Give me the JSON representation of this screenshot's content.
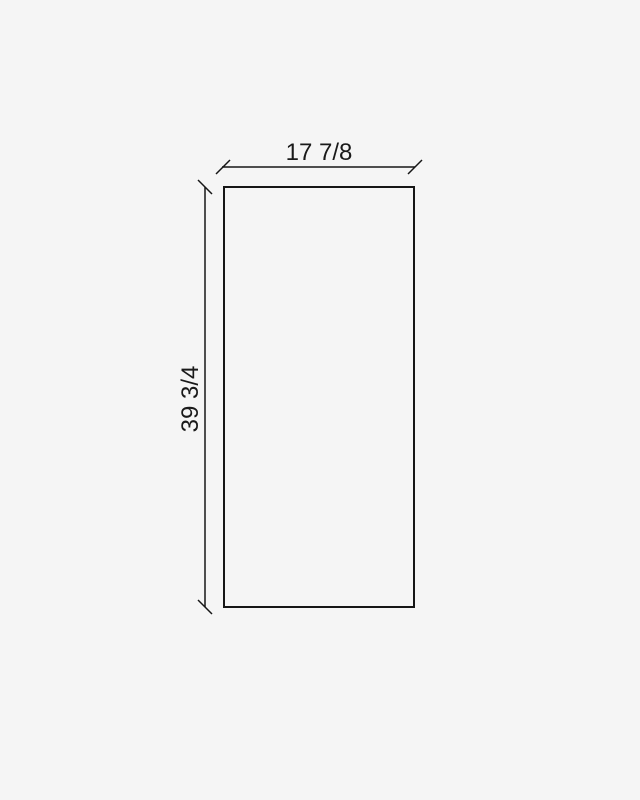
{
  "page": {
    "background_color": "#f5f5f5"
  },
  "diagram": {
    "kind": "dimension-drawing",
    "shape": "rectangle",
    "width_dimension": {
      "label": "17 7/8"
    },
    "height_dimension": {
      "label": "39 3/4"
    },
    "line_color": "#161616",
    "text_color": "#1a1a1a"
  }
}
